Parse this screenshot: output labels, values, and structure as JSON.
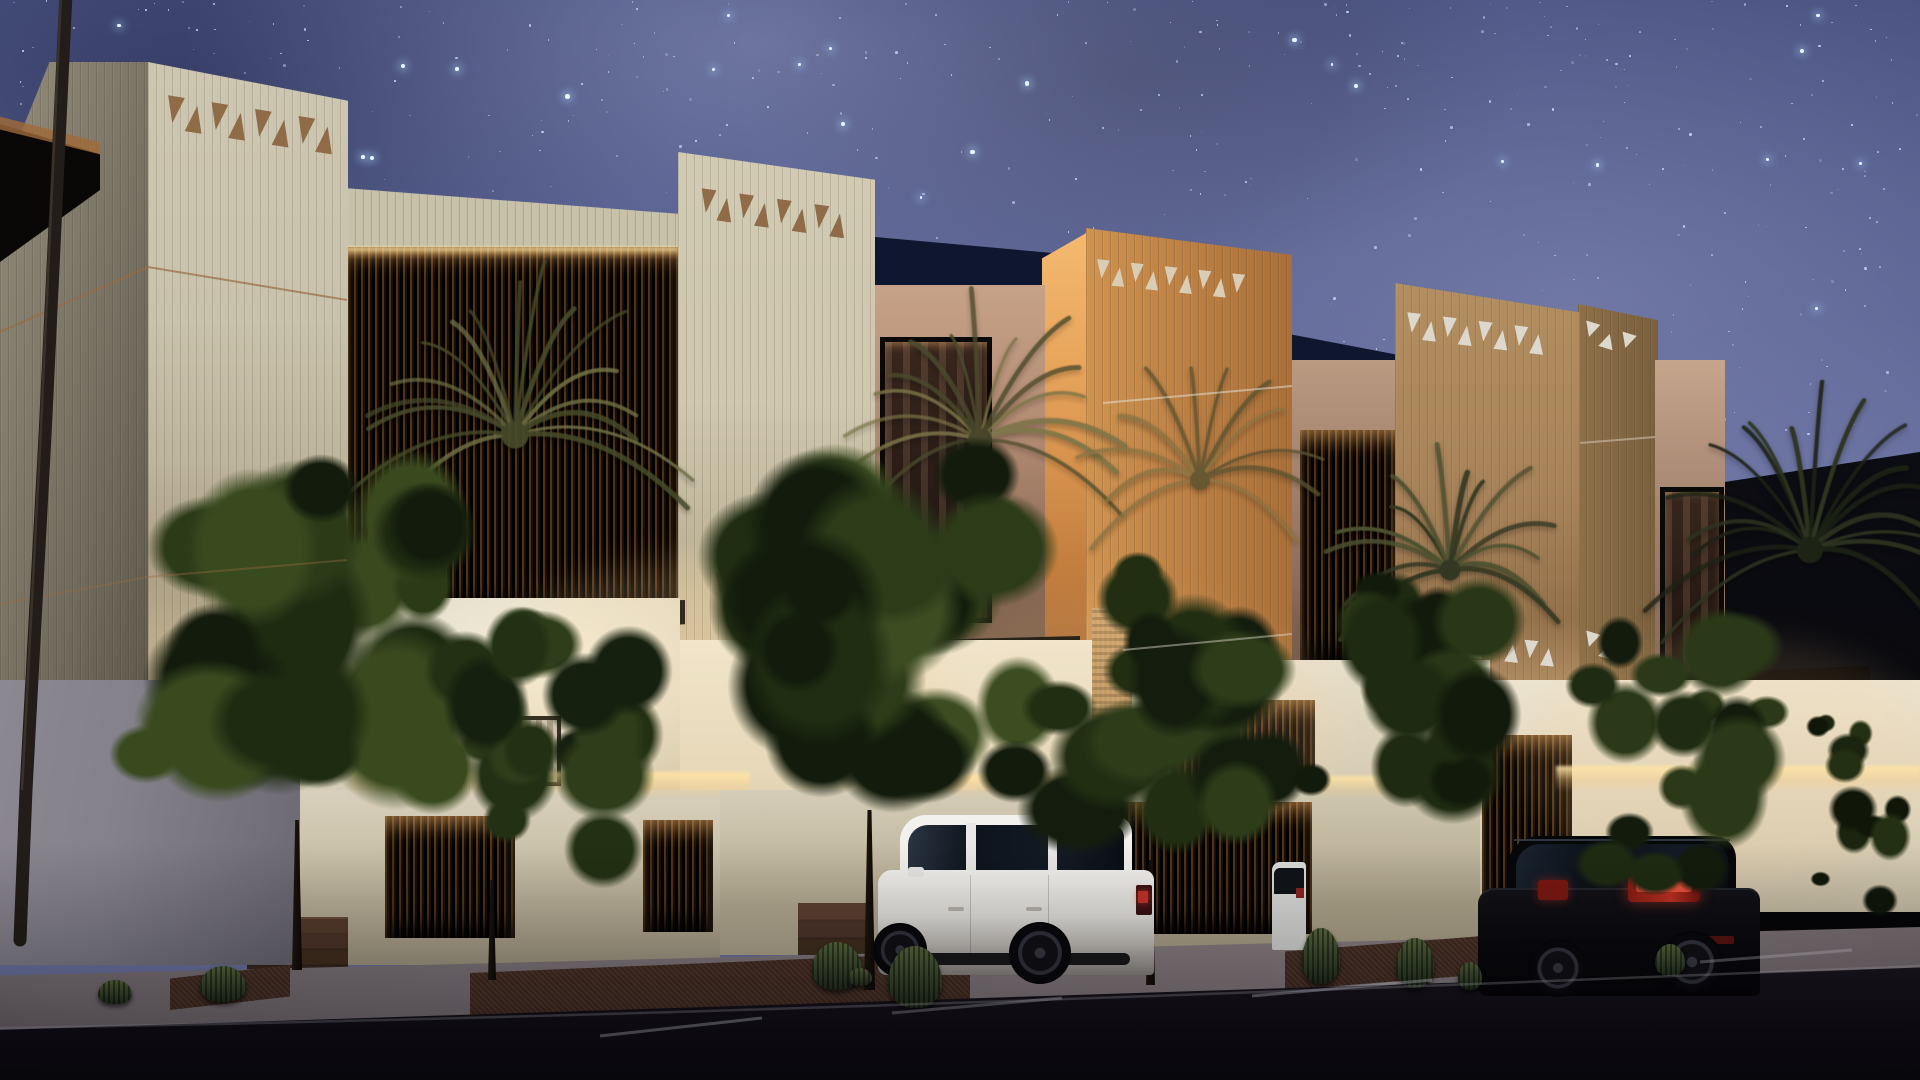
{
  "scene": {
    "description": "Photorealistic night-time architectural rendering of a row of modern Najdi-style villas under a starry Milky Way sky, with decorative triangle friezes on fluted towers, louvered screens with warm cove lighting, palm trees, street trees, barrel cacti, a white SUV and a black SUV parked on the street, and a curved streetlight pole at left",
    "time_of_day": "night",
    "objects": [
      "starry-sky",
      "milky-way",
      "villa-tower-1",
      "villa-tower-2",
      "villa-tower-3",
      "villa-tower-4",
      "triangle-friezes",
      "louvered-windows",
      "cove-lighting",
      "entry-door",
      "entry-steps",
      "palm-trees",
      "street-trees",
      "barrel-cacti",
      "white-suv",
      "black-suv",
      "parked-car-sliver",
      "streetlight-pole",
      "boundary-wall",
      "sidewalk",
      "asphalt-road",
      "parking-stall-lines"
    ]
  },
  "palette": {
    "skyTop": "#3f4878",
    "skyMid": "#5a6295",
    "skyLow": "#747ba9",
    "star": "#cfdcff",
    "starBright": "#eaf6ff",
    "cream": "#cdc6b0",
    "creamDeep": "#ab9f85",
    "creamSide": "#7c7667",
    "khaki": "#d2cbb4",
    "khakiDeep": "#bfb59a",
    "amber": "#cf9350",
    "amberDeep": "#a96f38",
    "amberGlow": "#f4b970",
    "tan": "#b28e60",
    "tanDeep": "#93714a",
    "tanSide": "#8d7048",
    "triBrown": "#8f6b47",
    "triLight": "#d9cdb6",
    "triWhite": "#ddd8ce",
    "navy": "#0f1730",
    "slab": "#060504",
    "louverBase": "#0b0703",
    "pink": "#c6a288",
    "pinkDeep": "#8a6a56",
    "glass": "#241712",
    "gfLit": "#f4eedd",
    "gfMid": "#e6dfcb",
    "gfDeep": "#d4ccb6",
    "cove": "#ffe2a0",
    "fence": "#d8d0bc",
    "fenceDeep": "#a89e86",
    "wood": "#6e4526",
    "step": "#553c2c",
    "stepDark": "#3a291e",
    "greyWall": "#8b8892",
    "greyWallDeep": "#6b6872",
    "walk": "#857b7f",
    "walkDeep": "#6d6468",
    "road": "#17131b",
    "roadDeep": "#0f0c12",
    "copper": "#9a6a40",
    "gravel": "#54392c",
    "poleDark": "#221d18",
    "suvWhite": "#f2f1ee",
    "suvShade": "#8f8b86",
    "suvGlass": "#0e141d",
    "tailRed": "#c33327",
    "blackCar": "#0a0a0e"
  },
  "gen": {
    "stars": {
      "count": 950,
      "bright_count": 66,
      "field_height": 0.72,
      "seed": 7
    },
    "band1": {
      "count": 8,
      "tri_w": 17,
      "tri_h": 27,
      "gap": 5,
      "color": "triBrown",
      "tilt": 9
    },
    "band2": {
      "count": 8,
      "tri_w": 15,
      "tri_h": 24,
      "gap": 4,
      "color": "triBrown",
      "tilt": 8
    },
    "band2b": {
      "count": 7,
      "tri_w": 15,
      "tri_h": 21,
      "gap": 4,
      "color": "triBrown",
      "tilt": 7
    },
    "band3": {
      "count": 9,
      "tri_w": 13,
      "tri_h": 19,
      "gap": 4,
      "color": "triLight",
      "tilt": 6
    },
    "band4a": {
      "count": 8,
      "tri_w": 14,
      "tri_h": 20,
      "gap": 4,
      "color": "triWhite",
      "tilt": 7
    },
    "band4b": {
      "count": 6,
      "tri_w": 14,
      "tri_h": 18,
      "gap": 4,
      "color": "triWhite",
      "tilt": 6
    },
    "band5a": {
      "count": 3,
      "tri_w": 15,
      "tri_h": 15,
      "gap": 4,
      "color": "triWhite",
      "tilt": 17
    },
    "band5b": {
      "count": 3,
      "tri_w": 15,
      "tri_h": 15,
      "gap": 4,
      "color": "triWhite",
      "tilt": 17
    },
    "palmA": {
      "fronds": 17,
      "len": 170,
      "c1": "#6f7044",
      "c2": "#474b2a",
      "seed": 5
    },
    "palmB": {
      "fronds": 15,
      "len": 150,
      "c1": "#7a7446",
      "c2": "#4a4a2c",
      "seed": 6
    },
    "palmC": {
      "fronds": 14,
      "len": 130,
      "c1": "#4c5130",
      "c2": "#333822",
      "seed": 8
    },
    "palmD": {
      "fronds": 12,
      "len": 125,
      "c1": "#8a7342",
      "c2": "#5a5230",
      "seed": 9
    },
    "palmE": {
      "fronds": 18,
      "len": 165,
      "c1": "#2e3520",
      "c2": "#1d2315",
      "seed": 10
    },
    "tree1": {
      "blobs": 26,
      "colors": [
        "#131c0c",
        "#1f2b11",
        "#2b3a17",
        "#3a4a1f"
      ],
      "seed": 11
    },
    "tree2": {
      "blobs": 18,
      "colors": [
        "#15200e",
        "#223013",
        "#2e3d1a"
      ],
      "seed": 12
    },
    "tree3": {
      "blobs": 28,
      "colors": [
        "#131c0c",
        "#202d12",
        "#2c3b18",
        "#3c4d22"
      ],
      "seed": 13
    },
    "tree4": {
      "blobs": 20,
      "colors": [
        "#141d0d",
        "#212e12",
        "#2d3c19"
      ],
      "seed": 14
    },
    "tree5": {
      "blobs": 18,
      "colors": [
        "#121a0b",
        "#1e2a11",
        "#293717"
      ],
      "seed": 15
    },
    "tree6": {
      "blobs": 18,
      "colors": [
        "#131c0c",
        "#1f2b12",
        "#2b3918"
      ],
      "seed": 16
    },
    "tree7": {
      "blobs": 12,
      "colors": [
        "#101708",
        "#1a240e",
        "#243013"
      ],
      "seed": 17
    }
  }
}
